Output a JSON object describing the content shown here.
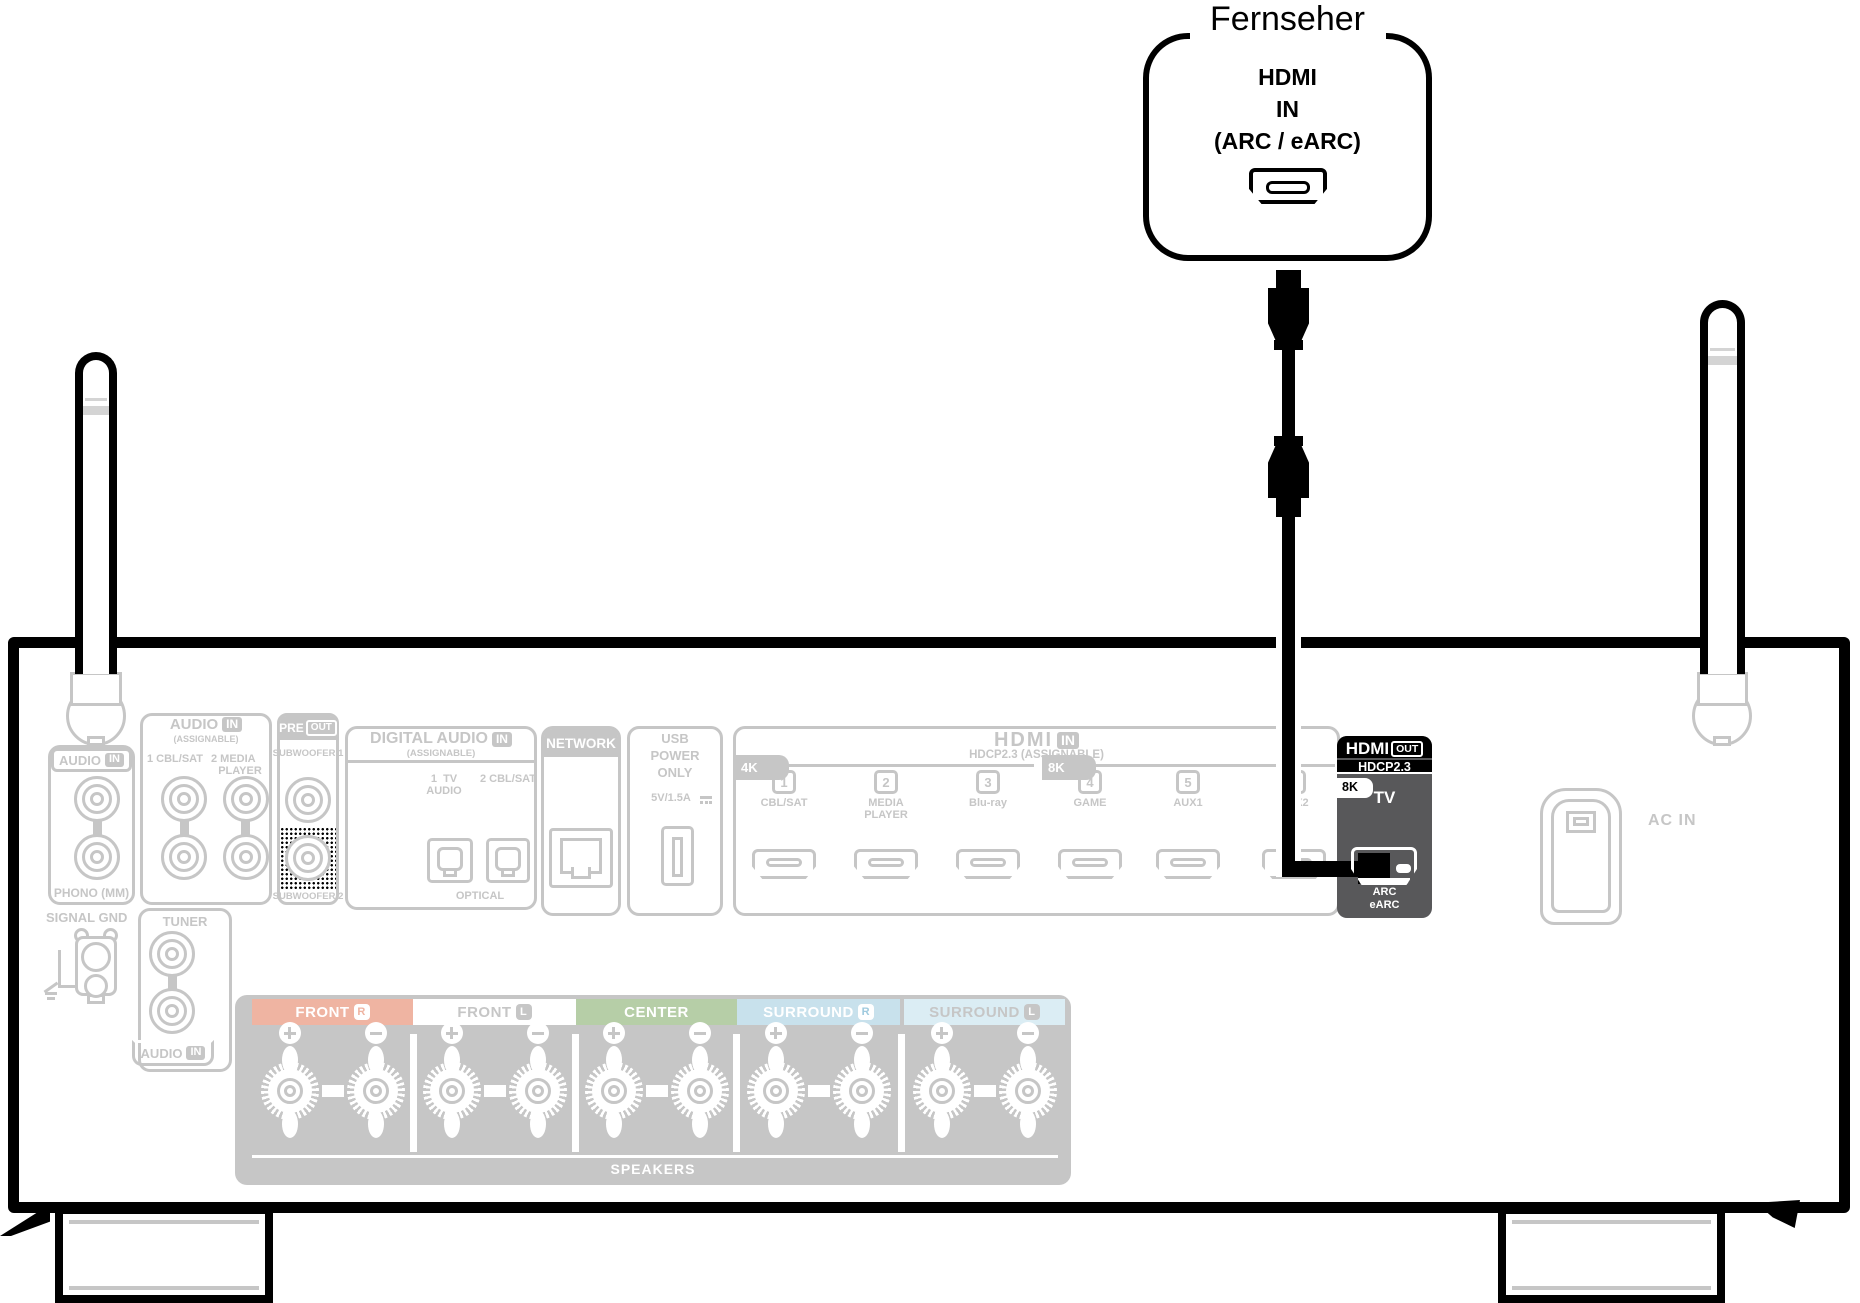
{
  "tv": {
    "title": "Fernseher",
    "line1": "HDMI",
    "line2": "IN",
    "line3": "(ARC / eARC)"
  },
  "receiver": {
    "phono": {
      "header_audio": "AUDIO",
      "header_in": "IN",
      "l": "L",
      "r": "R",
      "label": "PHONO (MM)"
    },
    "signal_gnd": "SIGNAL GND",
    "audio_in": {
      "header_audio": "AUDIO",
      "header_in": "IN",
      "assignable": "(ASSIGNABLE)",
      "col1": "1 CBL/SAT",
      "col2a": "2 MEDIA",
      "col2b": "PLAYER"
    },
    "tuner": {
      "title": "TUNER",
      "l": "L",
      "r": "R",
      "bottom_audio": "AUDIO",
      "bottom_in": "IN"
    },
    "preout": {
      "pre": "PRE",
      "out": "OUT",
      "sub1": "SUBWOOFER 1",
      "sub2": "SUBWOOFER 2"
    },
    "digital": {
      "title": "DIGITAL AUDIO",
      "in": "IN",
      "assignable": "(ASSIGNABLE)",
      "l1a": "1  TV",
      "l1b": "AUDIO",
      "l2": "2 CBL/SAT",
      "optical": "OPTICAL"
    },
    "network": {
      "header": "NETWORK"
    },
    "usb": {
      "l1": "USB",
      "l2": "POWER",
      "l3": "ONLY",
      "rating": "5V/1.5A"
    },
    "hdmi_in": {
      "hdmi": "HDMI",
      "in": "IN",
      "sub": "HDCP2.3 (ASSIGNABLE)",
      "tab4k": "4K",
      "tab8k": "8K",
      "ports": [
        {
          "num": "1",
          "lines": [
            "CBL/SAT"
          ]
        },
        {
          "num": "2",
          "lines": [
            "MEDIA",
            "PLAYER"
          ]
        },
        {
          "num": "3",
          "lines": [
            "Blu-ray"
          ]
        },
        {
          "num": "4",
          "lines": [
            "GAME"
          ]
        },
        {
          "num": "5",
          "lines": [
            "AUX1"
          ]
        },
        {
          "num": "6",
          "lines": [
            "AUX2"
          ]
        }
      ]
    },
    "hdmi_out": {
      "hdmi": "HDMI",
      "out": "OUT",
      "hdcp": "HDCP2.3",
      "tab8k": "8K",
      "tv": "TV",
      "arc": "ARC",
      "earc": "eARC"
    },
    "ac_in": "AC IN",
    "speakers": {
      "label": "SPEAKERS",
      "groups": [
        {
          "label": "FRONT",
          "ch": "R",
          "bg": "#efb4a2",
          "fg": "#ffffff",
          "badge_bg": "#ffffff",
          "badge_fg": "#efb4a2"
        },
        {
          "label": "FRONT",
          "ch": "L",
          "bg": "#ffffff",
          "fg": "#c6c6c6",
          "badge_bg": "#c6c6c6",
          "badge_fg": "#ffffff"
        },
        {
          "label": "CENTER",
          "ch": "",
          "bg": "#b6cea7",
          "fg": "#ffffff",
          "badge_bg": "#ffffff",
          "badge_fg": "#b6cea7"
        },
        {
          "label": "SURROUND",
          "ch": "R",
          "bg": "#c8e1ec",
          "fg": "#ffffff",
          "badge_bg": "#ffffff",
          "badge_fg": "#9fcade"
        },
        {
          "label": "SURROUND",
          "ch": "L",
          "bg": "#dbedf4",
          "fg": "#c6c6c6",
          "badge_bg": "#c6c6c6",
          "badge_fg": "#ffffff"
        }
      ]
    }
  },
  "colors": {
    "grayed": "#c6c6c6",
    "highlight": "#000000",
    "hdmi_out_body": "#58585a"
  }
}
